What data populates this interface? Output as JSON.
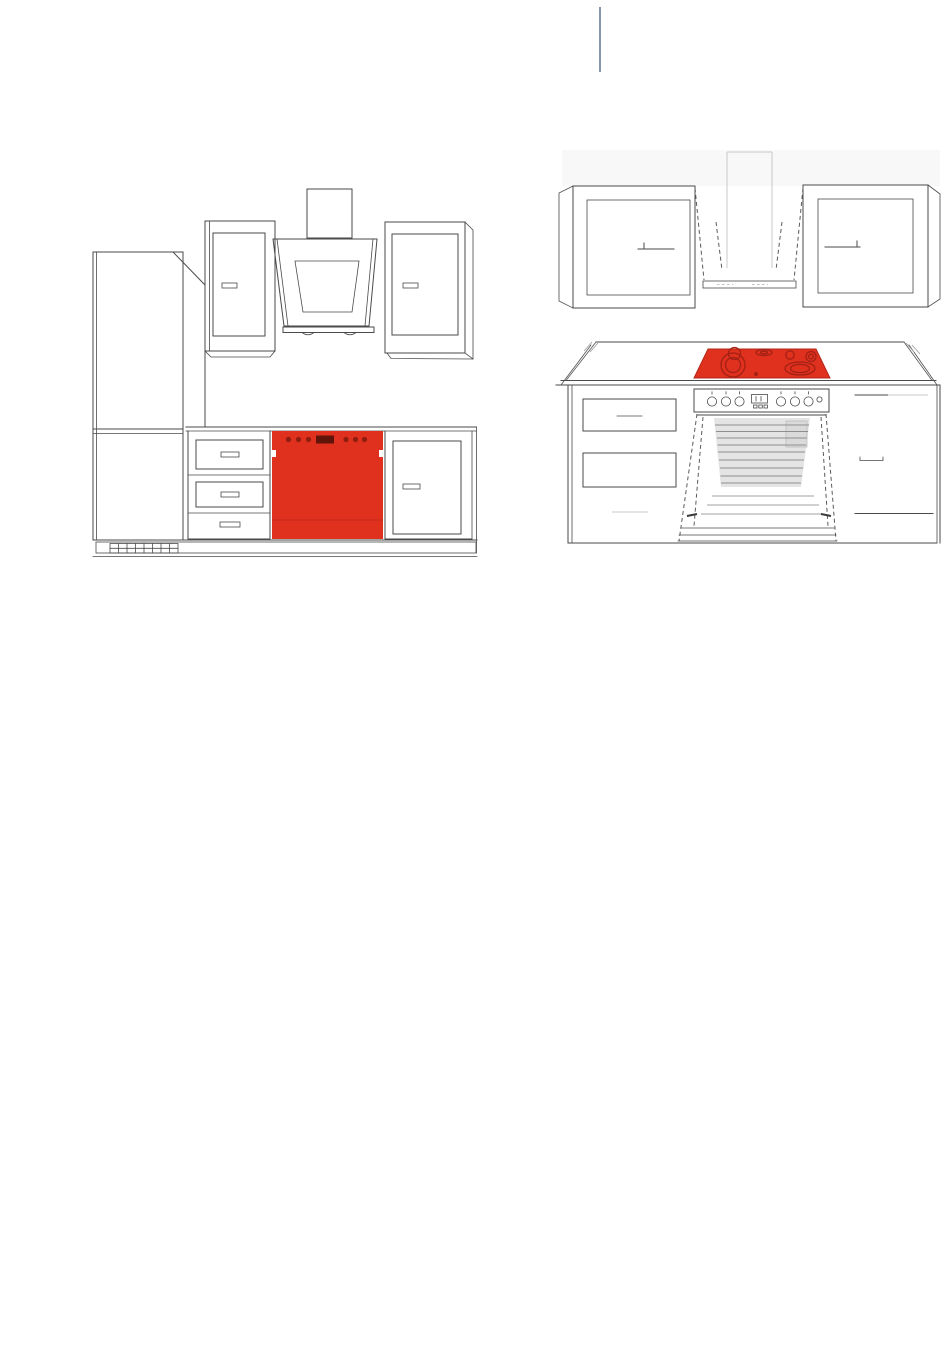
{
  "page": {
    "background": "#ffffff"
  },
  "divider": {
    "color": "#8694b2"
  },
  "palette": {
    "line": "#4a4a4a",
    "light_line": "#c9c9c9",
    "highlight_red": "#e0301e",
    "highlight_red_edge": "#b5281a",
    "burner_red": "#a32114",
    "control_red": "#8f1d10",
    "display_dark": "#611409",
    "door_line_red": "#c3291a",
    "cavity_gray": "#e4e4e4",
    "wall_tint": "#f8f8f8"
  },
  "figures": {
    "left": {
      "name": "kitchen-elevation-dishwasher-highlighted",
      "highlighted_part": "dishwasher"
    },
    "right": {
      "name": "kitchen-elevation-cooktop-highlighted",
      "highlighted_part": "cooktop"
    }
  }
}
